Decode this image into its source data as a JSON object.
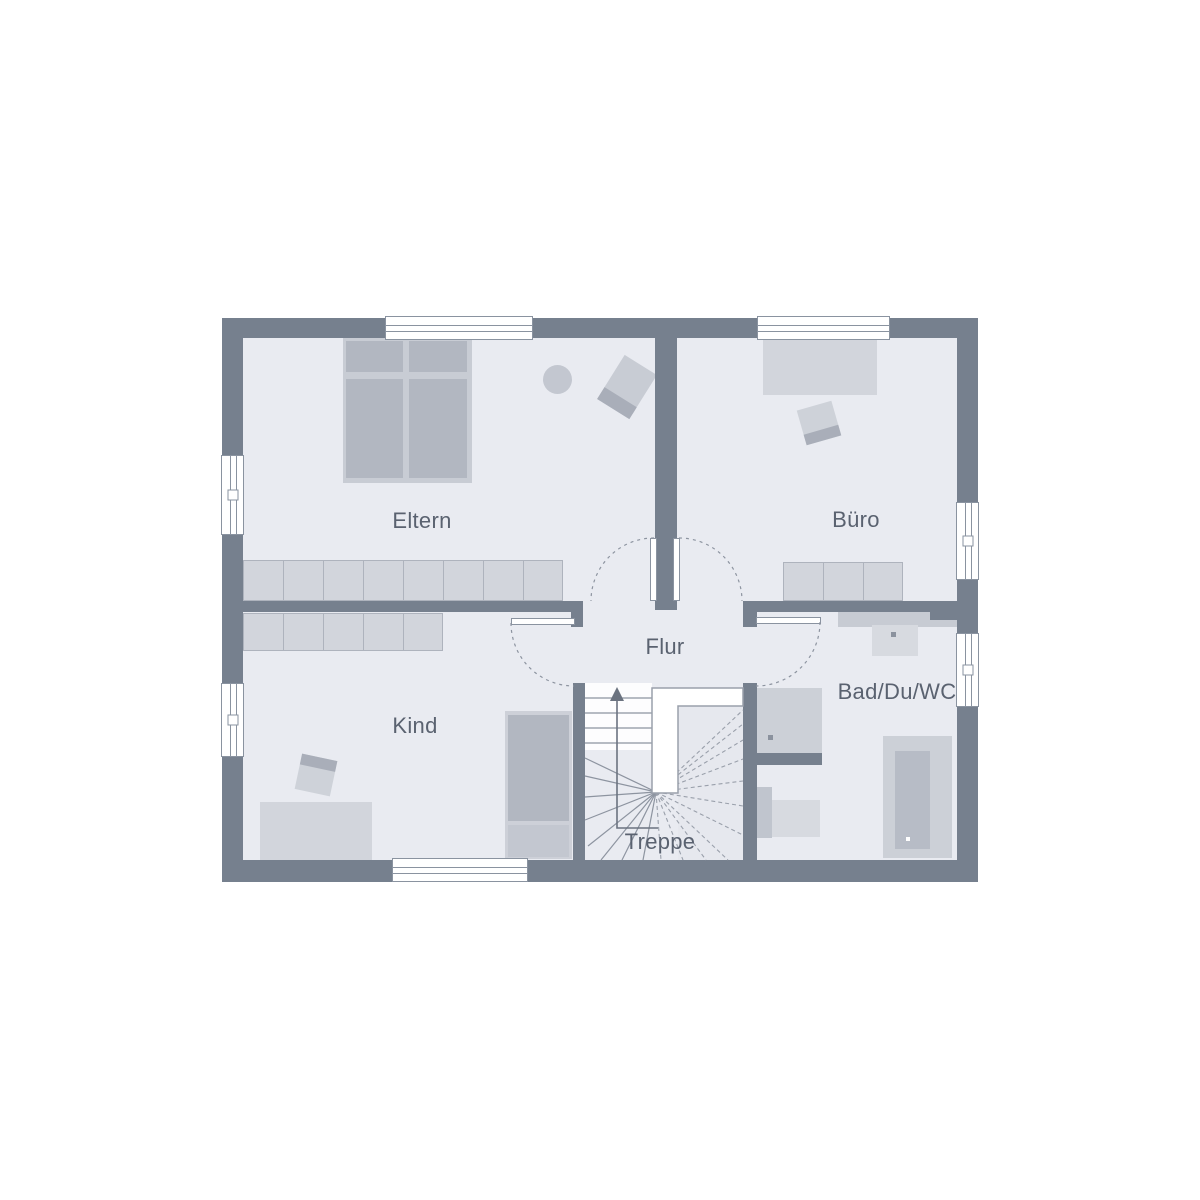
{
  "plan": {
    "title": "floor-plan-upper-floor",
    "rooms": [
      {
        "id": "eltern",
        "label": "Eltern"
      },
      {
        "id": "buero",
        "label": "Büro"
      },
      {
        "id": "kind",
        "label": "Kind"
      },
      {
        "id": "flur",
        "label": "Flur"
      },
      {
        "id": "bad",
        "label": "Bad/Du/WC"
      },
      {
        "id": "treppe",
        "label": "Treppe"
      }
    ],
    "colors": {
      "background": "#ffffff",
      "wall": "#76808e",
      "floor": "#e9ebf1",
      "furniture_light": "#d2d5dc",
      "furniture_medium": "#b2b7c1",
      "furniture_frame": "#c8ccd4",
      "divider": "#aeb3bd",
      "window_frame": "#8a93a0",
      "door_arc": "#8d94a0",
      "stair_solid": "#8d94a0",
      "stair_dashed": "#9aa0ab",
      "label_text": "#5a6270",
      "fixture_dot": "#8b929e"
    }
  }
}
